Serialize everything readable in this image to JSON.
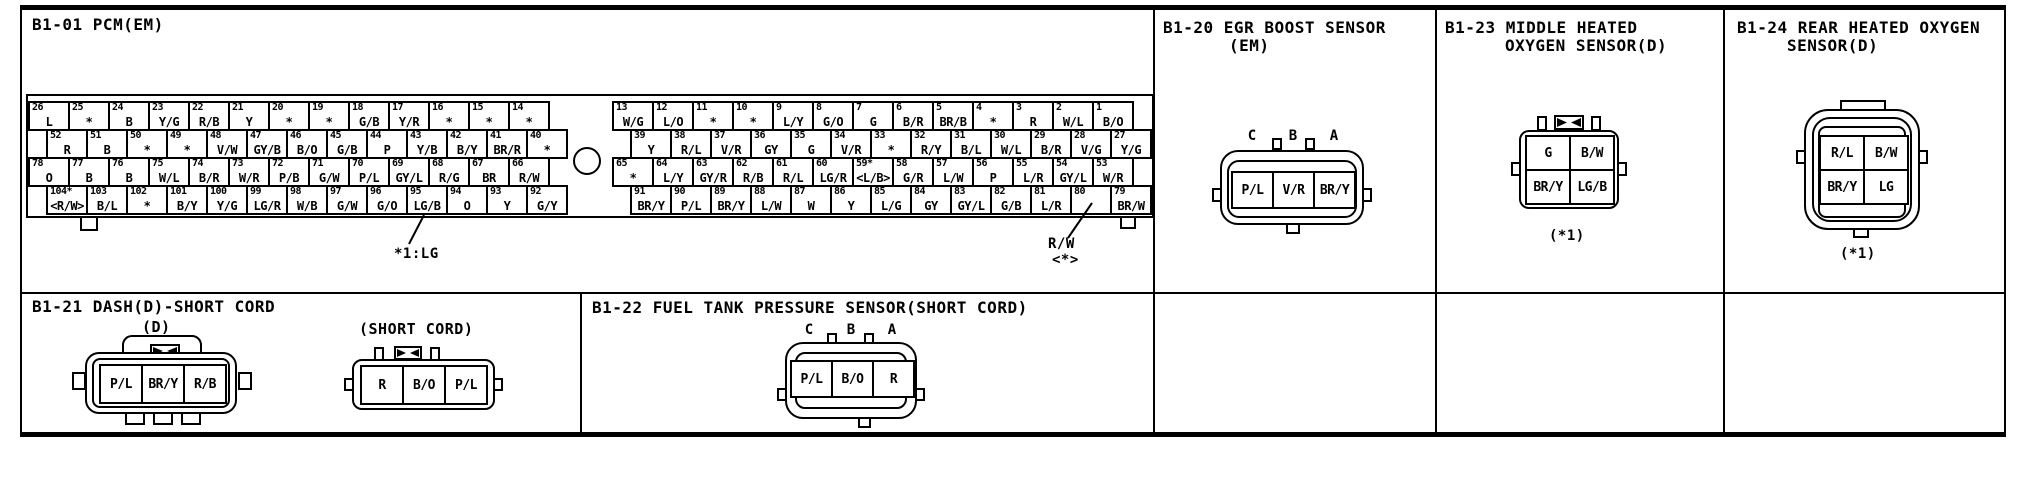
{
  "meta": {
    "colors": {
      "ink": "#000000",
      "paper": "#ffffff"
    }
  },
  "panels": {
    "pcm": {
      "title": "B1-01 PCM(EM)",
      "footnote": "*1:LG",
      "callout_wire": "R/W",
      "callout_marker": "<*>",
      "left_rows": [
        [
          [
            "26",
            "L"
          ],
          [
            "25",
            "*"
          ],
          [
            "24",
            "B"
          ],
          [
            "23",
            "Y/G"
          ],
          [
            "22",
            "R/B"
          ],
          [
            "21",
            "Y"
          ],
          [
            "20",
            "*"
          ],
          [
            "19",
            "*"
          ],
          [
            "18",
            "G/B"
          ],
          [
            "17",
            "Y/R"
          ],
          [
            "16",
            "*"
          ],
          [
            "15",
            "*"
          ],
          [
            "14",
            "*"
          ]
        ],
        [
          [
            "52",
            "R"
          ],
          [
            "51",
            "B"
          ],
          [
            "50",
            "*"
          ],
          [
            "49",
            "*"
          ],
          [
            "48",
            "V/W"
          ],
          [
            "47",
            "GY/B"
          ],
          [
            "46",
            "B/O"
          ],
          [
            "45",
            "G/B"
          ],
          [
            "44",
            "P"
          ],
          [
            "43",
            "Y/B"
          ],
          [
            "42",
            "B/Y"
          ],
          [
            "41",
            "BR/R"
          ],
          [
            "40",
            "*"
          ]
        ],
        [
          [
            "78",
            "O"
          ],
          [
            "77",
            "B"
          ],
          [
            "76",
            "B"
          ],
          [
            "75",
            "W/L"
          ],
          [
            "74",
            "B/R"
          ],
          [
            "73",
            "W/R"
          ],
          [
            "72",
            "P/B"
          ],
          [
            "71",
            "G/W"
          ],
          [
            "70",
            "P/L"
          ],
          [
            "69",
            "GY/L"
          ],
          [
            "68",
            "R/G"
          ],
          [
            "67",
            "BR"
          ],
          [
            "66",
            "R/W"
          ]
        ],
        [
          [
            "104*",
            "<R/W>"
          ],
          [
            "103",
            "B/L"
          ],
          [
            "102",
            "*"
          ],
          [
            "101",
            "B/Y"
          ],
          [
            "100",
            "Y/G"
          ],
          [
            "99",
            "LG/R"
          ],
          [
            "98",
            "W/B"
          ],
          [
            "97",
            "G/W"
          ],
          [
            "96",
            "G/O"
          ],
          [
            "95",
            "LG/B"
          ],
          [
            "94",
            "O"
          ],
          [
            "93",
            "Y"
          ],
          [
            "92",
            "G/Y"
          ]
        ]
      ],
      "right_rows": [
        [
          [
            "13",
            "W/G"
          ],
          [
            "12",
            "L/O"
          ],
          [
            "11",
            "*"
          ],
          [
            "10",
            "*"
          ],
          [
            "9",
            "L/Y"
          ],
          [
            "8",
            "G/O"
          ],
          [
            "7",
            "G"
          ],
          [
            "6",
            "B/R"
          ],
          [
            "5",
            "BR/B"
          ],
          [
            "4",
            "*"
          ],
          [
            "3",
            "R"
          ],
          [
            "2",
            "W/L"
          ],
          [
            "1",
            "B/O"
          ]
        ],
        [
          [
            "39",
            "Y"
          ],
          [
            "38",
            "R/L"
          ],
          [
            "37",
            "V/R"
          ],
          [
            "36",
            "GY"
          ],
          [
            "35",
            "G"
          ],
          [
            "34",
            "V/R"
          ],
          [
            "33",
            "*"
          ],
          [
            "32",
            "R/Y"
          ],
          [
            "31",
            "B/L"
          ],
          [
            "30",
            "W/L"
          ],
          [
            "29",
            "B/R"
          ],
          [
            "28",
            "V/G"
          ],
          [
            "27",
            "Y/G"
          ]
        ],
        [
          [
            "65",
            "*"
          ],
          [
            "64",
            "L/Y"
          ],
          [
            "63",
            "GY/R"
          ],
          [
            "62",
            "R/B"
          ],
          [
            "61",
            "R/L"
          ],
          [
            "60",
            "LG/R"
          ],
          [
            "59*",
            "<L/B>"
          ],
          [
            "58",
            "G/R"
          ],
          [
            "57",
            "L/W"
          ],
          [
            "56",
            "P"
          ],
          [
            "55",
            "L/R"
          ],
          [
            "54",
            "GY/L"
          ],
          [
            "53",
            "W/R"
          ]
        ],
        [
          [
            "91",
            "BR/Y"
          ],
          [
            "90",
            "P/L"
          ],
          [
            "89",
            "BR/Y"
          ],
          [
            "88",
            "L/W"
          ],
          [
            "87",
            "W"
          ],
          [
            "86",
            "Y"
          ],
          [
            "85",
            "L/G"
          ],
          [
            "84",
            "GY"
          ],
          [
            "83",
            "GY/L"
          ],
          [
            "82",
            "G/B"
          ],
          [
            "81",
            "L/R"
          ],
          [
            "80",
            ""
          ],
          [
            "79",
            "BR/W"
          ]
        ]
      ]
    },
    "egr": {
      "title_line1": "B1-20 EGR BOOST SENSOR",
      "title_line2": "(EM)",
      "letters": [
        "C",
        "B",
        "A"
      ],
      "pins": [
        "P/L",
        "V/R",
        "BR/Y"
      ]
    },
    "mid": {
      "title_line1": "B1-23 MIDDLE HEATED",
      "title_line2": "OXYGEN SENSOR(D)",
      "pins": [
        [
          "G",
          "B/W"
        ],
        [
          "BR/Y",
          "LG/B"
        ]
      ],
      "note": "(*1)"
    },
    "rear": {
      "title_line1": "B1-24 REAR HEATED OXYGEN",
      "title_line2": "SENSOR(D)",
      "pins": [
        [
          "R/L",
          "B/W"
        ],
        [
          "BR/Y",
          "LG"
        ]
      ],
      "note": "(*1)"
    },
    "dash": {
      "title": "B1-21 DASH(D)-SHORT CORD",
      "sub1_label": "(D)",
      "sub1_pins": [
        "P/L",
        "BR/Y",
        "R/B"
      ],
      "sub2_label": "(SHORT CORD)",
      "sub2_pins": [
        "R",
        "B/O",
        "P/L"
      ]
    },
    "fuel": {
      "title": "B1-22 FUEL TANK PRESSURE SENSOR(SHORT CORD)",
      "letters": [
        "C",
        "B",
        "A"
      ],
      "pins": [
        "P/L",
        "B/O",
        "R"
      ]
    }
  }
}
